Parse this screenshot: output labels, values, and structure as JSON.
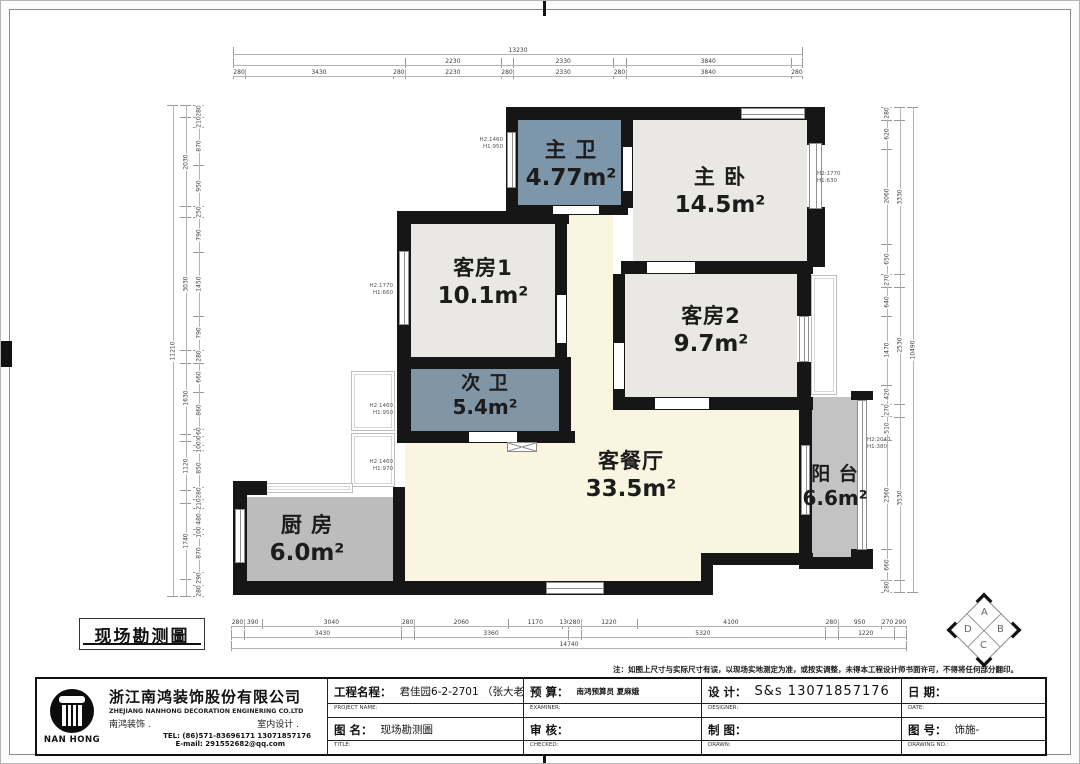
{
  "plan_title": {
    "label": "现场勘测圖"
  },
  "rooms": {
    "master_bath": {
      "name": "主 卫",
      "area": "4.77m²",
      "fill": "#7d96a9"
    },
    "master_bed": {
      "name": "主 卧",
      "area": "14.5m²",
      "fill": "#e9e8e5"
    },
    "guest1": {
      "name": "客房1",
      "area": "10.1m²",
      "fill": "#e9e8e5"
    },
    "guest2": {
      "name": "客房2",
      "area": "9.7m²",
      "fill": "#e9e8e5"
    },
    "second_bath": {
      "name": "次 卫",
      "area": "5.4m²",
      "fill": "#8096a6"
    },
    "living": {
      "name": "客餐厅",
      "area": "33.5m²",
      "fill": "#faf5e1"
    },
    "kitchen": {
      "name": "厨 房",
      "area": "6.0m²",
      "fill": "#bcbcbc"
    },
    "balcony": {
      "name": "阳 台",
      "area": "6.6m²",
      "fill": "#c3c3c3"
    }
  },
  "window_labels": [
    {
      "l1": "H2:1460",
      "l2": "H1:950"
    },
    {
      "l1": "H2:1770",
      "l2": "H1:660"
    },
    {
      "l1": "H2:1770",
      "l2": "H1:630"
    },
    {
      "l1": "H2:1460",
      "l2": "H1:950"
    },
    {
      "l1": "H2:1460",
      "l2": "H1:970"
    },
    {
      "l1": "H2:2040",
      "l2": "H1:380"
    }
  ],
  "dims": {
    "top": {
      "overall": [
        [
          13230,
          "13230"
        ]
      ],
      "mid": [
        [
          3990,
          ""
        ],
        [
          2230,
          "2230"
        ],
        [
          280,
          ""
        ],
        [
          2330,
          "2330"
        ],
        [
          280,
          ""
        ],
        [
          3840,
          "3840"
        ],
        [
          280,
          ""
        ]
      ],
      "detail": [
        [
          280,
          "280"
        ],
        [
          3430,
          "3430"
        ],
        [
          280,
          "280"
        ],
        [
          2230,
          "2230"
        ],
        [
          280,
          "280"
        ],
        [
          2330,
          "2330"
        ],
        [
          280,
          "280"
        ],
        [
          3840,
          "3840"
        ],
        [
          280,
          "280"
        ]
      ]
    },
    "bottom": {
      "detail": [
        [
          280,
          "280"
        ],
        [
          390,
          "390"
        ],
        [
          3040,
          "3040"
        ],
        [
          280,
          "280"
        ],
        [
          2060,
          "2060"
        ],
        [
          1170,
          "1170"
        ],
        [
          130,
          "130"
        ],
        [
          280,
          "280"
        ],
        [
          1220,
          "1220"
        ],
        [
          4100,
          "4100"
        ],
        [
          280,
          "280"
        ],
        [
          950,
          "950"
        ],
        [
          270,
          "270"
        ],
        [
          290,
          "290"
        ]
      ],
      "mid": [
        [
          280,
          ""
        ],
        [
          3430,
          "3430"
        ],
        [
          280,
          ""
        ],
        [
          3360,
          "3360"
        ],
        [
          280,
          ""
        ],
        [
          5320,
          "5320"
        ],
        [
          280,
          ""
        ],
        [
          1220,
          "1220"
        ],
        [
          290,
          ""
        ]
      ],
      "overall": [
        [
          14740,
          "14740"
        ]
      ]
    },
    "left": {
      "overall": [
        [
          11210,
          "11210"
        ]
      ],
      "mid": [
        [
          280,
          ""
        ],
        [
          2030,
          "2030"
        ],
        [
          250,
          ""
        ],
        [
          3030,
          "3030"
        ],
        [
          280,
          ""
        ],
        [
          1630,
          "1630"
        ],
        [
          160,
          ""
        ],
        [
          1120,
          "1120"
        ],
        [
          280,
          ""
        ],
        [
          1740,
          "1740"
        ],
        [
          410,
          ""
        ]
      ],
      "detail": [
        [
          280,
          "280"
        ],
        [
          210,
          "210"
        ],
        [
          870,
          "870"
        ],
        [
          950,
          "950"
        ],
        [
          250,
          "250"
        ],
        [
          790,
          "790"
        ],
        [
          1450,
          "1450"
        ],
        [
          790,
          "790"
        ],
        [
          280,
          "280"
        ],
        [
          660,
          "660"
        ],
        [
          860,
          "860"
        ],
        [
          160,
          "160"
        ],
        [
          200,
          "200"
        ],
        [
          100,
          "100"
        ],
        [
          850,
          "850"
        ],
        [
          280,
          "280"
        ],
        [
          210,
          "210"
        ],
        [
          480,
          "480"
        ],
        [
          100,
          "100"
        ],
        [
          870,
          "870"
        ],
        [
          290,
          "290"
        ],
        [
          280,
          "280"
        ]
      ]
    },
    "right": {
      "detail": [
        [
          280,
          "280"
        ],
        [
          620,
          "620"
        ],
        [
          2060,
          "2060"
        ],
        [
          650,
          "650"
        ],
        [
          270,
          "270"
        ],
        [
          640,
          "640"
        ],
        [
          1470,
          "1470"
        ],
        [
          420,
          "420"
        ],
        [
          270,
          "270"
        ],
        [
          510,
          "510"
        ],
        [
          2360,
          "2360"
        ],
        [
          660,
          "660"
        ],
        [
          280,
          "280"
        ]
      ],
      "mid": [
        [
          280,
          ""
        ],
        [
          3330,
          "3330"
        ],
        [
          270,
          ""
        ],
        [
          2530,
          "2530"
        ],
        [
          270,
          ""
        ],
        [
          3530,
          "3530"
        ],
        [
          280,
          ""
        ]
      ],
      "overall": [
        [
          10490,
          "10490"
        ]
      ]
    }
  },
  "compass": {
    "top": "A",
    "right": "B",
    "bottom": "C",
    "left": "D"
  },
  "note": "注：如图上尺寸与实际尺寸有误，以现场实地测定为准，或按实调整，未得本工程设计师书面许可，不得将任何部分翻印。",
  "titleblock": {
    "company": {
      "cn": "浙江南鸿装饰股份有限公司",
      "en": "ZHEJIANG NANHONG DECORATION ENGINERING CO.LTD",
      "sub1": "南鸿装饰 .",
      "sub2": "室内设计 .",
      "tel": "TEL: (86)571-83696171  13071857176",
      "email": "E-mail: 291552682@qq.com",
      "logo": "NAN HONG"
    },
    "fields": {
      "project_label": "工程名程：",
      "project_value": "君佳园6-2-2701 （张大老板娘）",
      "project_caption": "PROJECT NAME:",
      "drawing_label": "图  名：",
      "drawing_value": "现场勘测圖",
      "drawing_caption": "TITLE:",
      "budget_label": "预    算：",
      "budget_value": "南鸿预算员 夏麻娥",
      "budget_caption": "EXAMINER:",
      "check_label": "审    核：",
      "check_value": "",
      "check_caption": "CHECKED:",
      "design_label": "设    计：",
      "design_value": "S&s  13071857176",
      "design_caption": "DESIGNER:",
      "draw_label": "制    图：",
      "draw_value": "",
      "draw_caption": "DRAWN:",
      "date_label": "日    期：",
      "date_value": "",
      "date_caption": "DATE:",
      "no_label": "图    号：",
      "no_value": "饰施-",
      "no_caption": "DRAWING NO.:"
    }
  }
}
